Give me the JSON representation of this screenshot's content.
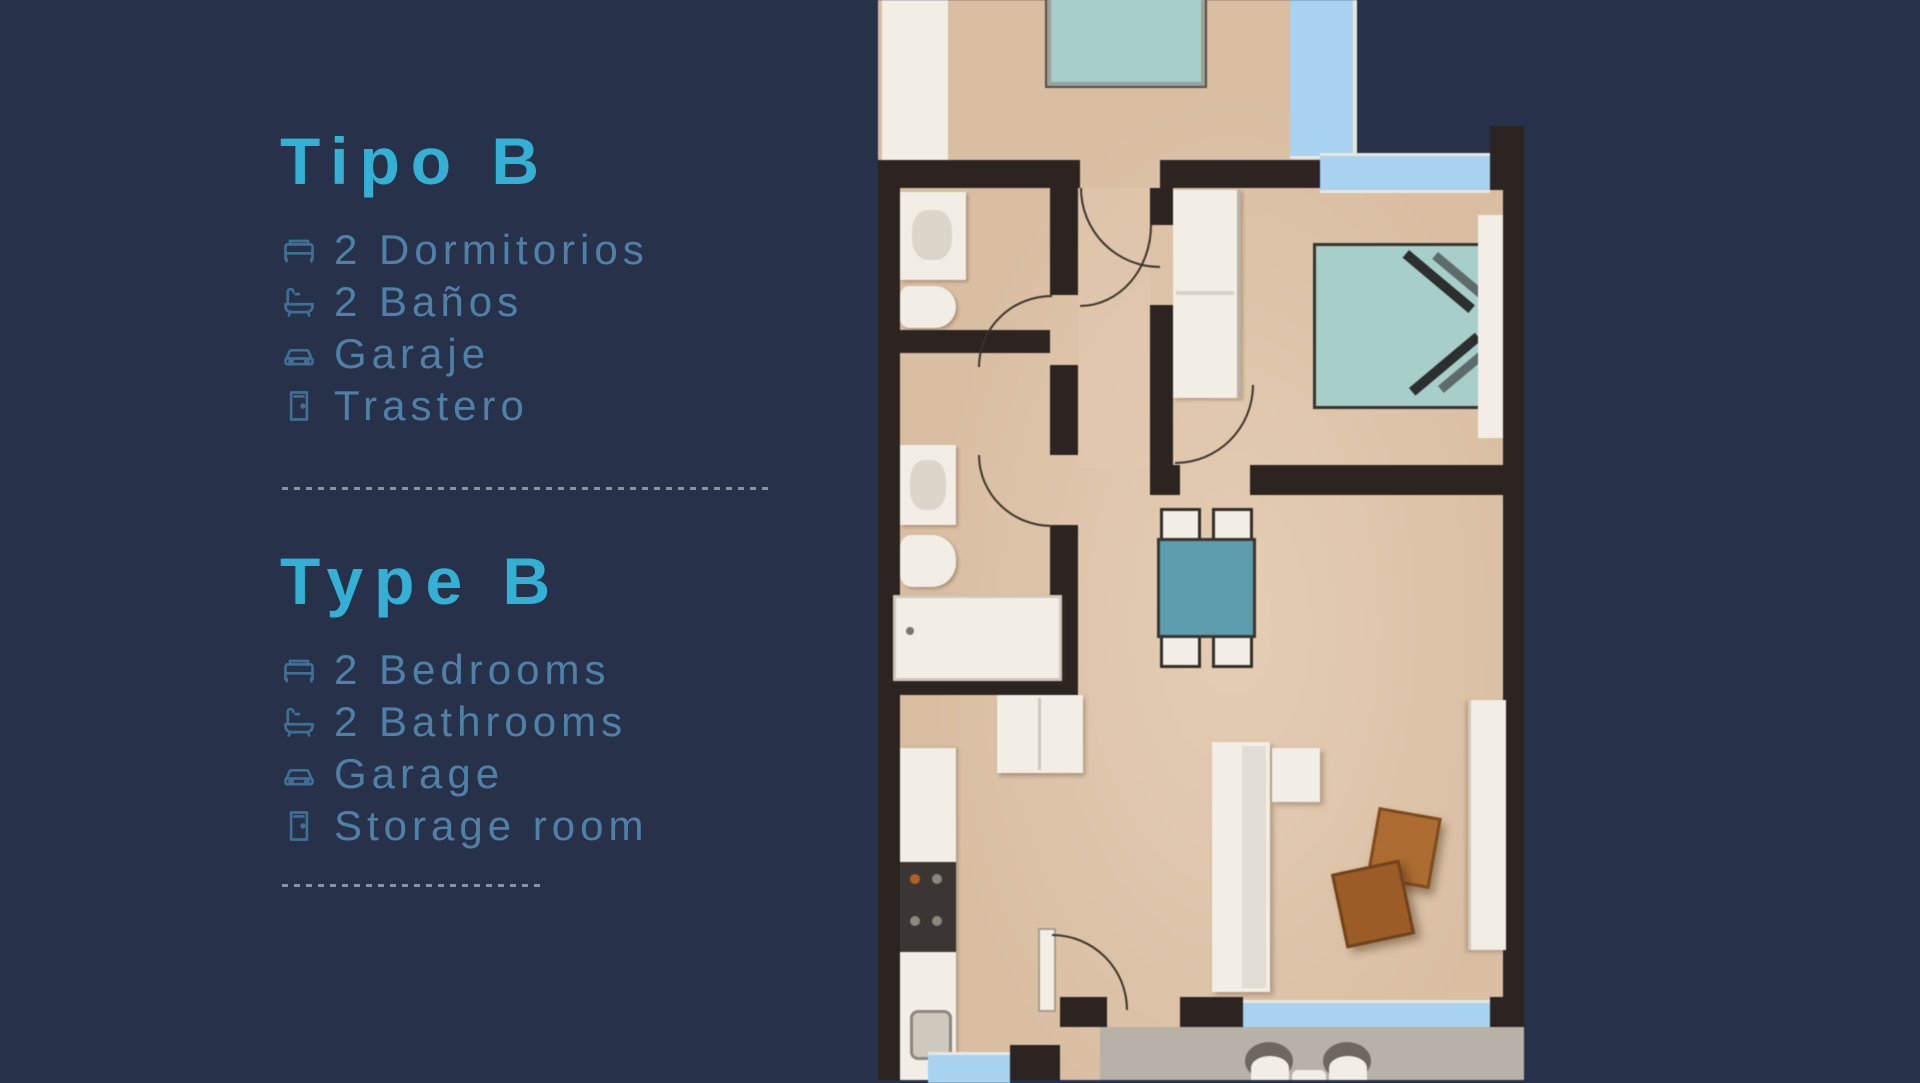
{
  "background_color": "#273149",
  "panel": {
    "heading_color": "#34b0d4",
    "text_color": "#4e80a8",
    "sections": [
      {
        "title": "Tipo B",
        "items": [
          {
            "icon": "bed-icon",
            "label": "2 Dormitorios"
          },
          {
            "icon": "bath-icon",
            "label": "2 Baños"
          },
          {
            "icon": "car-icon",
            "label": "Garaje"
          },
          {
            "icon": "door-icon",
            "label": "Trastero"
          }
        ]
      },
      {
        "title": "Type B",
        "items": [
          {
            "icon": "bed-icon",
            "label": "2 Bedrooms"
          },
          {
            "icon": "bath-icon",
            "label": "2 Bathrooms"
          },
          {
            "icon": "car-icon",
            "label": "Garage"
          },
          {
            "icon": "door-icon",
            "label": "Storage room"
          }
        ]
      }
    ]
  },
  "floorplan": {
    "type": "apartment-top-view-render",
    "colors": {
      "floor": "#d9bea2",
      "walls": "#2b2420",
      "fixtures_white": "#f2eee6",
      "bed_teal": "#a7cec8",
      "table_teal": "#5d9dad",
      "window_blue": "#a7d3f0",
      "terrace_gray": "#b8b1a8",
      "wood_orange": "#ad6c31"
    },
    "rooms": [
      "bedroom-1",
      "bathroom-1",
      "bathroom-2",
      "hallway",
      "bedroom-2",
      "kitchen",
      "living-dining-room",
      "terrace"
    ],
    "furniture": [
      "double-bed",
      "double-bed-chevron-pillows",
      "wardrobe",
      "dining-table-4-chairs",
      "sofa",
      "ottoman",
      "wooden-armchairs",
      "sideboard",
      "kitchen-counter",
      "stove",
      "fridge",
      "kitchen-sink",
      "vanity-sink",
      "toilet",
      "bathtub",
      "shower-tray",
      "terrace-chairs",
      "terrace-table",
      "interior-doors"
    ]
  }
}
